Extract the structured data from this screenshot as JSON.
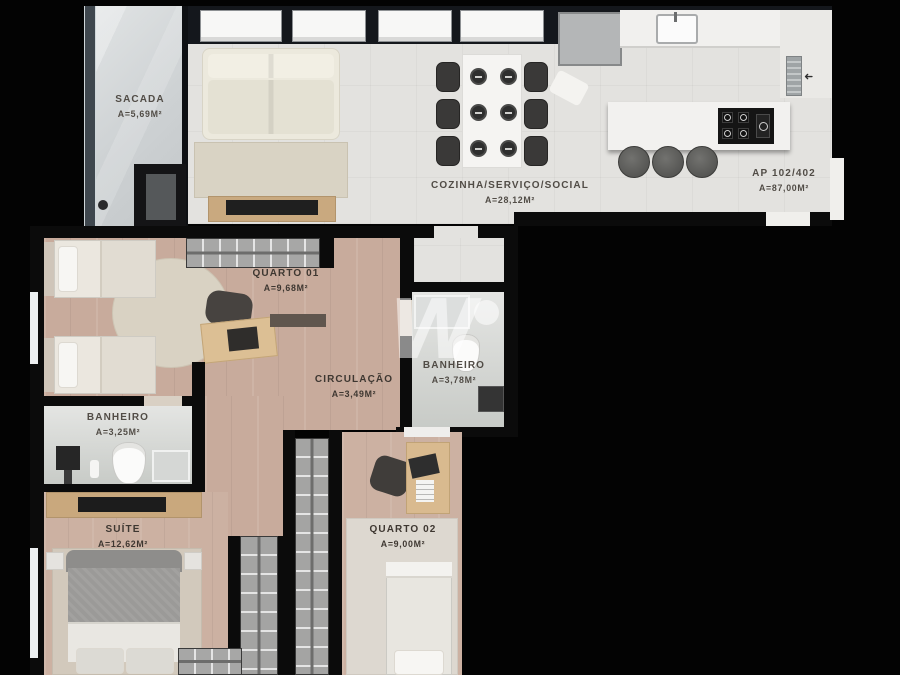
{
  "apartment": {
    "unit": "AP 102/402",
    "area": "A=87,00m²"
  },
  "rooms": {
    "sacada": {
      "name": "SACADA",
      "area": "A=5,69m²"
    },
    "cozinha": {
      "name": "COZINHA/SERVIÇO/SOCIAL",
      "area": "A=28,12m²"
    },
    "quarto01": {
      "name": "QUARTO 01",
      "area": "A=9,68m²"
    },
    "banheiro_social": {
      "name": "BANHEIRO",
      "area": "A=3,78m²"
    },
    "circulacao": {
      "name": "CIRCULAÇÃO",
      "area": "A=3,49m²"
    },
    "banheiro_suite": {
      "name": "BANHEIRO",
      "area": "A=3,25m²"
    },
    "suite": {
      "name": "SUÍTE",
      "area": "A=12,62m²"
    },
    "quarto02": {
      "name": "QUARTO 02",
      "area": "A=9,00m²"
    }
  },
  "watermark": {
    "letter": "W"
  },
  "colors": {
    "background": "#000000",
    "wall": "#0b0b0b",
    "wood_floor": "#c8ab9c",
    "tile_floor": "#e3e2df",
    "wardrobe_gray": "#a4a4a3",
    "counter_wood": "#c9a87d"
  }
}
